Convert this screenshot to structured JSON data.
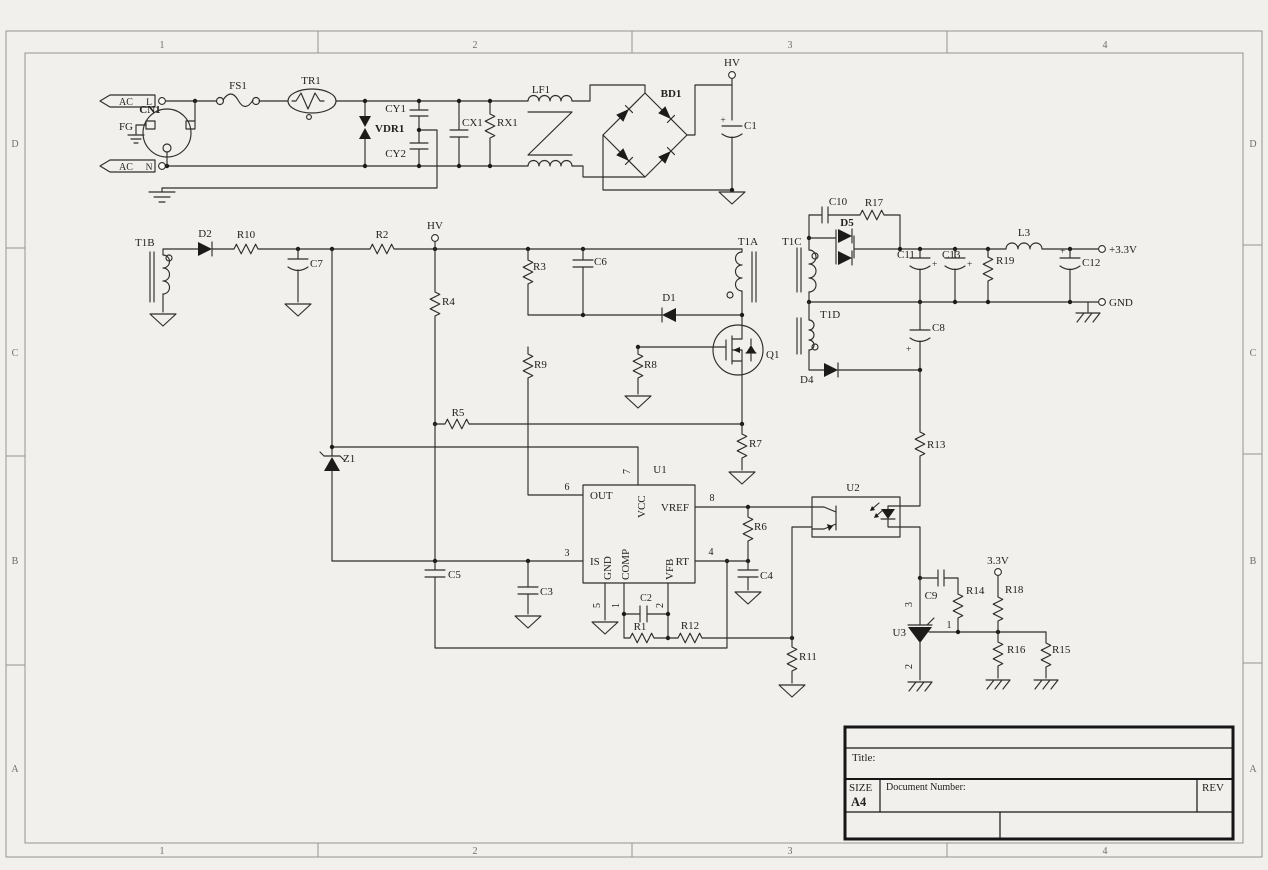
{
  "frame": {
    "zone_cols": [
      "1",
      "2",
      "3",
      "4"
    ],
    "zone_rows": [
      "D",
      "C",
      "B",
      "A"
    ]
  },
  "title_block": {
    "title_label": "Title:",
    "size_label": "SIZE",
    "size_value": "A4",
    "doc_number_label": "Document Number:",
    "rev_label": "REV"
  },
  "marks": {
    "plus": "+"
  },
  "nets": {
    "ac_l": "AC",
    "l": "L",
    "ac_n": "AC",
    "n": "N",
    "fg": "FG",
    "hv_top": "HV",
    "hv_mid": "HV",
    "p3v3": "+3.3V",
    "gnd_out": "GND",
    "v33": "3.3V"
  },
  "components": {
    "cn1": "CN1",
    "fs1": "FS1",
    "tr1": "TR1",
    "vdr1": "VDR1",
    "cy1": "CY1",
    "cy2": "CY2",
    "cx1": "CX1",
    "rx1": "RX1",
    "lf1": "LF1",
    "bd1": "BD1",
    "c1": "C1",
    "t1b": "T1B",
    "d2": "D2",
    "r10": "R10",
    "c7": "C7",
    "r2": "R2",
    "r4": "R4",
    "r3": "R3",
    "c6": "C6",
    "d1": "D1",
    "t1a": "T1A",
    "q1": "Q1",
    "r9": "R9",
    "r8": "R8",
    "r5": "R5",
    "r7": "R7",
    "z1": "Z1",
    "c5": "C5",
    "c3": "C3",
    "c2": "C2",
    "r1": "R1",
    "r12": "R12",
    "r11": "R11",
    "r6": "R6",
    "c4": "C4",
    "t1c": "T1C",
    "c10": "C10",
    "r17": "R17",
    "d5": "D5",
    "c11": "C11",
    "c13": "C13",
    "r19": "R19",
    "l3": "L3",
    "c12": "C12",
    "t1d": "T1D",
    "d4": "D4",
    "c8": "C8",
    "r13": "R13",
    "u2": "U2",
    "u3": "U3",
    "c9": "C9",
    "r14": "R14",
    "r18": "R18",
    "r16": "R16",
    "r15": "R15"
  },
  "u1": {
    "name": "U1",
    "out": "OUT",
    "vcc": "VCC",
    "vref": "VREF",
    "is_pin": "IS",
    "gnd": "GND",
    "comp": "COMP",
    "vfb": "VFB",
    "rt": "RT",
    "p1": "1",
    "p2": "2",
    "p3": "3",
    "p4": "4",
    "p5": "5",
    "p6": "6",
    "p7": "7",
    "p8": "8"
  },
  "u3_pins": {
    "p1": "1",
    "p2": "2",
    "p3": "3"
  }
}
